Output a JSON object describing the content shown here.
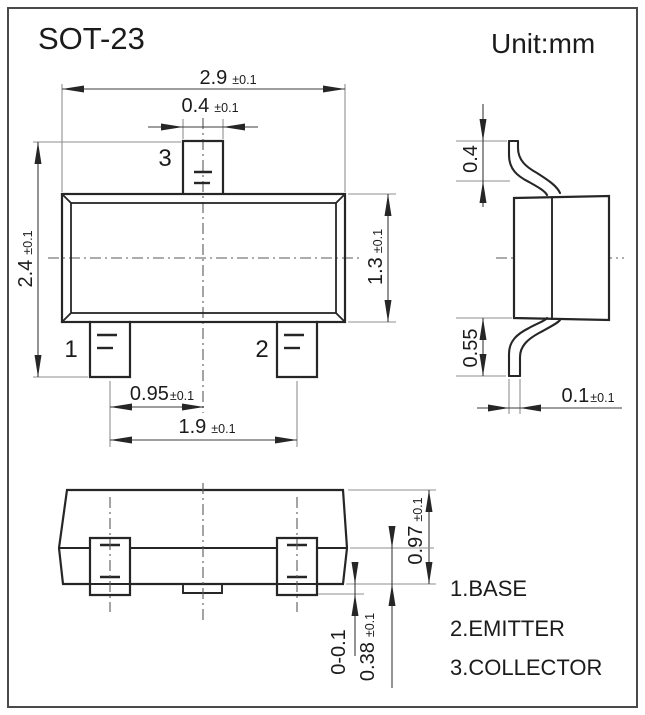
{
  "title": "SOT-23",
  "unit_label": "Unit:mm",
  "views": {
    "front": {
      "pin1": "1",
      "pin2": "2",
      "pin3": "3",
      "dims": {
        "body_width": {
          "value": "2.9",
          "tol": "±0.1"
        },
        "lead3_width": {
          "value": "0.4",
          "tol": "±0.1"
        },
        "total_height": {
          "value": "2.4",
          "tol": "±0.1"
        },
        "body_height": {
          "value": "1.3",
          "tol": "±0.1"
        },
        "pin_pitch": {
          "value": "0.95",
          "tol": "±0.1"
        },
        "pin_span": {
          "value": "1.9",
          "tol": "±0.1"
        }
      }
    },
    "side": {
      "dims": {
        "top_lead_length": {
          "value": "0.4",
          "tol": ""
        },
        "bottom_lead_length": {
          "value": "0.55",
          "tol": ""
        },
        "lead_thickness": {
          "value": "0.1",
          "tol": "±0.1"
        }
      }
    },
    "bottom": {
      "dims": {
        "body_side_height": {
          "value": "0.97",
          "tol": "±0.1"
        },
        "lead_foot_height": {
          "value": "0.38",
          "tol": "±0.1"
        },
        "standoff": {
          "value": "0-0.1",
          "tol": ""
        }
      }
    }
  },
  "legend": {
    "items": [
      {
        "label": "1.BASE"
      },
      {
        "label": "2.EMITTER"
      },
      {
        "label": "3.COLLECTOR"
      }
    ]
  },
  "colors": {
    "object_line": "#262626",
    "dimension_line": "#3c3c3c",
    "extension_line": "#8f8f8f",
    "text": "#1b1b1b",
    "background": "#ffffff"
  }
}
